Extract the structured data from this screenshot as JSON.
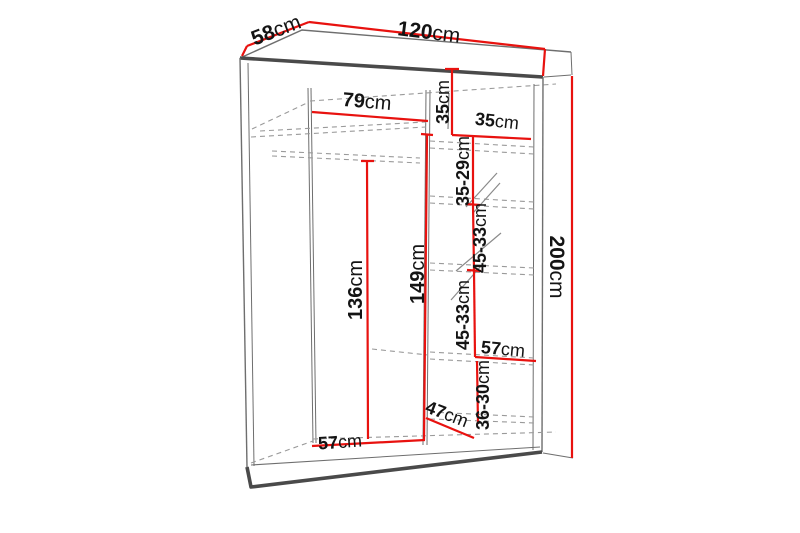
{
  "diagram": {
    "type": "wardrobe-dimension-diagram",
    "colors": {
      "dimension_line": "#e8120f",
      "structure_line": "#6e6e6e",
      "structure_dark": "#4a4a4a",
      "hidden_line": "#9a9a9a",
      "label_text": "#141414"
    },
    "labels": {
      "depth": {
        "num": "58",
        "unit": "cm"
      },
      "width": {
        "num": "120",
        "unit": "cm"
      },
      "height": {
        "num": "200",
        "unit": "cm"
      },
      "left_width": {
        "num": "79",
        "unit": "cm"
      },
      "top_section": {
        "num": "35",
        "unit": "cm"
      },
      "right_width": {
        "num": "35",
        "unit": "cm"
      },
      "gap1": {
        "num": "35-29",
        "unit": "cm"
      },
      "gap2": {
        "num": "45-33",
        "unit": "cm"
      },
      "gap3": {
        "num": "45-33",
        "unit": "cm"
      },
      "right_shelf_depth": {
        "num": "57",
        "unit": "cm"
      },
      "gap4": {
        "num": "36-30",
        "unit": "cm"
      },
      "bottom_depth": {
        "num": "47",
        "unit": "cm"
      },
      "hanging_height": {
        "num": "136",
        "unit": "cm"
      },
      "interior_height": {
        "num": "149",
        "unit": "cm"
      },
      "floor_depth": {
        "num": "57",
        "unit": "cm"
      }
    }
  }
}
